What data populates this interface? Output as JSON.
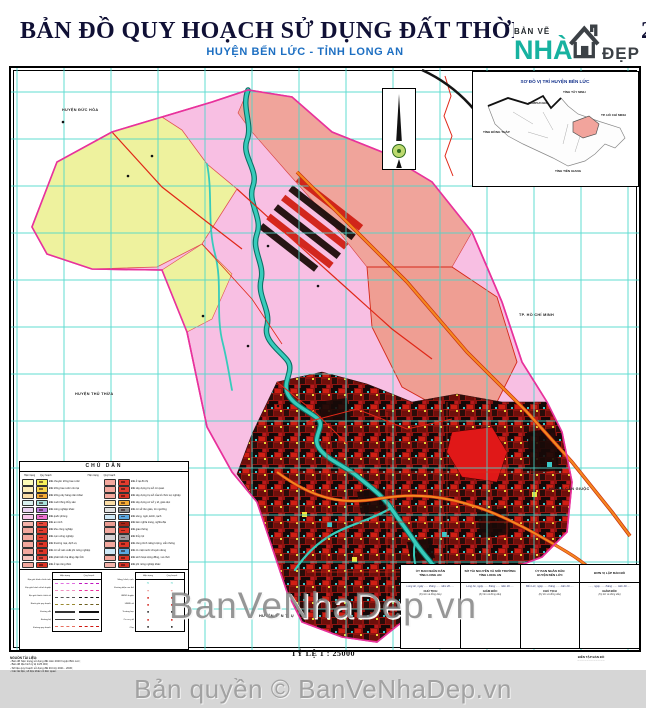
{
  "title": {
    "main": "BẢN ĐỒ QUY HOẠCH SỬ DỤNG ĐẤT THỜI KỲ 2021 - 2030",
    "sub": "HUYỆN BẾN LỨC - TỈNH LONG AN"
  },
  "logo": {
    "small": "BẢN VẼ",
    "word1": "NHÀ",
    "word2": "ĐẸP"
  },
  "map": {
    "labels": [
      "HUYỆN ĐỨC HÒA",
      "TP. HỒ CHÍ MINH",
      "HUYỆN THỦ THỪA",
      "HUYỆN CẦN GIUỘC",
      "HUYỆN TÂN TRỤ"
    ],
    "colors": {
      "grid": "#46d7cb",
      "river": "#38cbbb",
      "orange_road": "#f5871f",
      "red_road": "#e02818",
      "boundary": "#e8329c",
      "pink_zone": "#f8bfe3",
      "yellow_zone": "#eef29e",
      "salmon_zone": "#f0a49b",
      "urban_zone": "#8f1410"
    }
  },
  "inset": {
    "title": "SƠ ĐỒ VỊ TRÍ HUYỆN BẾN LỨC",
    "labels": [
      "CAMPUCHIA",
      "TỈNH TÂY NINH",
      "TP. HỒ CHÍ MINH",
      "TỈNH ĐỒNG THÁP",
      "TỈNH TIỀN GIANG"
    ]
  },
  "legend": {
    "title": "CHÚ DẪN",
    "col_headers": [
      "Hiện trạng",
      "Quy hoạch"
    ],
    "left": [
      {
        "c1": "#fdfcb8",
        "c2": "#f6ef5a",
        "label": "Đất chuyên trồng lúa nước"
      },
      {
        "c1": "#fdeeb8",
        "c2": "#f8d44a",
        "label": "Đất trồng lúa nước còn lại"
      },
      {
        "c1": "#fbdda6",
        "c2": "#f5ab35",
        "label": "Đất trồng cây hàng năm khác"
      },
      {
        "c1": "#d9f0ee",
        "c2": "#a9e3db",
        "label": "Đất nuôi trồng thủy sản"
      },
      {
        "c1": "#ead2f2",
        "c2": "#bf7de2",
        "label": "Đất nông nghiệp khác"
      },
      {
        "c1": "#f8c6ea",
        "c2": "#ef6fd2",
        "label": "Đất quốc phòng"
      },
      {
        "c1": "#f5b3aa",
        "c2": "#e8473a",
        "label": "Đất an ninh"
      },
      {
        "c1": "#f3a89e",
        "c2": "#e23c2e",
        "label": "Đất khu công nghiệp"
      },
      {
        "c1": "#f3a89e",
        "c2": "#e23c2e",
        "label": "Đất cụm công nghiệp"
      },
      {
        "c1": "#f3a89e",
        "c2": "#de3526",
        "label": "Đất thương mại, dịch vụ"
      },
      {
        "c1": "#f3a89e",
        "c2": "#de3526",
        "label": "Đất cơ sở sản xuất phi nông nghiệp"
      },
      {
        "c1": "#f7c3bc",
        "c2": "#e8473a",
        "label": "Đất phát triển hạ tầng cấp tỉnh"
      },
      {
        "c1": "#f3a89e",
        "c2": "#de3526",
        "label": "Đất ở tại nông thôn"
      }
    ],
    "right": [
      {
        "c1": "#f3a89e",
        "c2": "#e23c2e",
        "label": "Đất ở tại đô thị"
      },
      {
        "c1": "#f3a89e",
        "c2": "#e23c2e",
        "label": "Đất xây dựng trụ sở cơ quan"
      },
      {
        "c1": "#f3a89e",
        "c2": "#de3526",
        "label": "Đất xây dựng trụ sở của tổ chức sự nghiệp"
      },
      {
        "c1": "#fbdda6",
        "c2": "#f5ab35",
        "label": "Đất xây dựng cơ sở y tế, giáo dục"
      },
      {
        "c1": "#e2e2e2",
        "c2": "#8f8f8f",
        "label": "Đất cơ sở tôn giáo, tín ngưỡng"
      },
      {
        "c1": "#cfe9f7",
        "c2": "#5aa8e0",
        "label": "Đất sông, ngòi, kênh, rạch"
      },
      {
        "c1": "#eb9c92",
        "c2": "#a92417",
        "label": "Đất làm nghĩa trang, nghĩa địa"
      },
      {
        "c1": "#f3a89e",
        "c2": "#de3526",
        "label": "Đất giao thông"
      },
      {
        "c1": "#d8d4d6",
        "c2": "#a09a9d",
        "label": "Đất thủy lợi"
      },
      {
        "c1": "#f3a89e",
        "c2": "#de3526",
        "label": "Đất công trình năng lượng, viễn thông"
      },
      {
        "c1": "#cfe9f7",
        "c2": "#5aa8e0",
        "label": "Đất có mặt nước chuyên dùng"
      },
      {
        "c1": "#f3a89e",
        "c2": "#de3526",
        "label": "Đất sinh hoạt cộng đồng, vui chơi"
      },
      {
        "c1": "#f5b3aa",
        "c2": "#d93225",
        "label": "Đất phi nông nghiệp khác"
      }
    ],
    "line_left": [
      {
        "label": "Địa giới hành chính tỉnh",
        "style": "dash-magenta"
      },
      {
        "label": "Địa giới hành chính huyện",
        "style": "dash-pink"
      },
      {
        "label": "Địa giới hành chính xã",
        "style": "dashdot-black"
      },
      {
        "label": "Ranh giới quy hoạch",
        "style": "dash-olive"
      },
      {
        "label": "Đường sắt",
        "style": "rail-black"
      },
      {
        "label": "Đường bộ",
        "style": "solid-black"
      },
      {
        "label": "Đường quy hoạch",
        "style": "dash-red"
      }
    ],
    "line_right": [
      {
        "label": "Sông, kênh, rạch",
        "style": "wave-cyan"
      },
      {
        "label": "Đường điện cao thế",
        "style": "zig-red"
      },
      {
        "label": "UBND huyện",
        "style": "dot-red"
      },
      {
        "label": "UBND xã",
        "style": "dot-red"
      },
      {
        "label": "Trường học",
        "style": "dot-black"
      },
      {
        "label": "Cơ sở y tế",
        "style": "dot-red"
      },
      {
        "label": "Chợ",
        "style": "dot-black"
      }
    ]
  },
  "signature_table": {
    "columns": [
      {
        "header": "ỦY BAN NHÂN DÂN\nTỈNH LONG AN",
        "lines": [
          "Long An, ngày ...... tháng ...... năm 20......",
          "CHỦ TỊCH",
          "(Ký tên và đóng dấu)"
        ]
      },
      {
        "header": "SỞ TÀI NGUYÊN VÀ MÔI TRƯỜNG\nTỈNH LONG AN",
        "lines": [
          "Long An, ngày ...... tháng ...... năm 20......",
          "GIÁM ĐỐC",
          "(Ký tên và đóng dấu)"
        ]
      },
      {
        "header": "ỦY BAN NHÂN DÂN\nHUYỆN BẾN LỨC",
        "lines": [
          "Bến Lức, ngày ...... tháng ...... năm 20......",
          "CHỦ TỊCH",
          "(Ký tên và đóng dấu)"
        ]
      },
      {
        "header": "ĐƠN VỊ LẬP BẢN ĐỒ",
        "lines": [
          "......, ngày ...... tháng ...... năm 20......",
          "GIÁM ĐỐC",
          "(Ký tên và đóng dấu)"
        ]
      }
    ]
  },
  "notes": {
    "header": "NGUỒN TÀI LIỆU:",
    "lines": [
      "- Bản đồ hiện trạng sử dụng đất năm 2020 huyện Bến Lức;",
      "- Bản đồ địa hình tỷ lệ 1/25.000;",
      "- Số liệu quy hoạch sử dụng đất thời kỳ 2021 - 2030;",
      "- Các tài liệu, số liệu khác có liên quan."
    ]
  },
  "credit": {
    "line1": "BIÊN TẬP BẢN ĐỒ",
    "line2": "........................................"
  },
  "scale": {
    "text": "TỶ LỆ 1 : 25000"
  },
  "watermark": {
    "text": "BanVeNhaDep.vn"
  },
  "footer": {
    "text": "Bản quyền © BanVeNhaDep.vn"
  }
}
